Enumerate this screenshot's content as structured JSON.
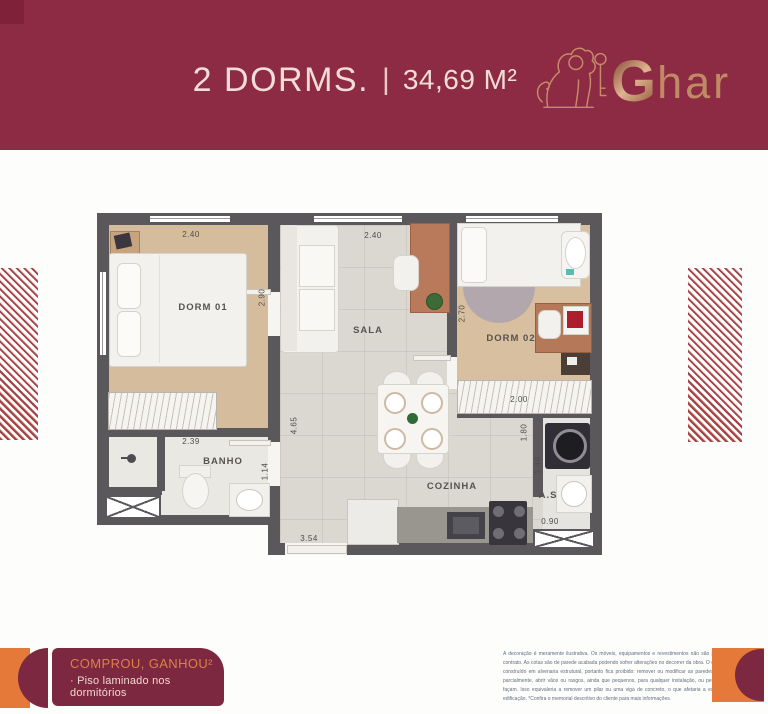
{
  "header": {
    "title": {
      "left": "2 DORMS.",
      "separator": "|",
      "right": "34,69 M²"
    },
    "brand": {
      "initial": "G",
      "rest": "har"
    }
  },
  "plan": {
    "labels": {
      "dorm1": "DORM 01",
      "sala": "SALA",
      "dorm2": "DORM 02",
      "banho": "BANHO",
      "cozinha": "COZINHA",
      "area_servico": "A.S"
    },
    "dims": {
      "dorm1_width": "2.40",
      "dorm1_depth": "2.90",
      "sala_width": "2.40",
      "corridor_depth": "4.65",
      "dorm2_depth": "2.70",
      "dorm2_closet_width": "2.00",
      "banho_width": "2.39",
      "banho_depth": "1.14",
      "cozinha_width": "3.54",
      "as_depth_1": "1.80",
      "as_depth_2": "1.49",
      "as_width": "0.90"
    }
  },
  "promo": {
    "headline": "COMPROU, GANHOU²",
    "item": "· Piso laminado nos dormitórios"
  },
  "disclaimer": "A decoração é meramente ilustrativa. Os móveis, equipamentos e revestimentos não são partes integrantes do contrato. As cotas são de parede acabada podendo sofrer alterações no decorrer da obra. O empreendimento será construído em alvenaria estrutural, portanto fica proibido: remover ou modificar as paredes estruturais, total ou parcialmente, abrir vãos ou rasgos, ainda que pequenos, para qualquer instalação, ou permitir que terceiros o façam. Isso equivaleria a remover um pilar ou uma viga de concreto, o que afetaria a estabilidade de toda a edificação. *Confira o memorial descritivo do cliente para mais informações.",
  "colors": {
    "header_bg": "#8c2b43",
    "promo_bg": "#7c2840",
    "accent_orange": "#e4793a",
    "brand_copper": "#c08a66",
    "wall": "#5b585c",
    "wood_floor": "#d5bc9c",
    "tile_floor": "#dbd8d2"
  }
}
